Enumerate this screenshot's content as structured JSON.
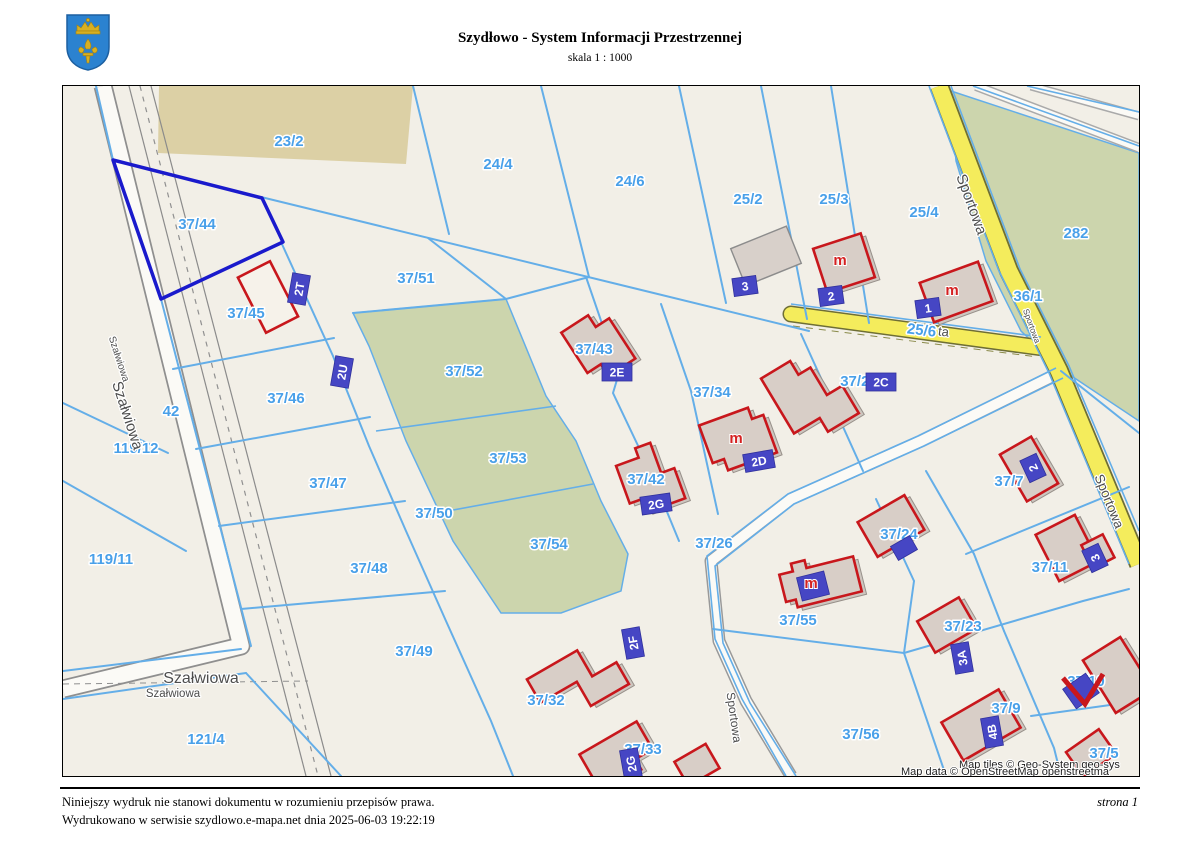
{
  "header": {
    "title": "Szydłowo - System Informacji Przestrzennej",
    "scale": "skala 1 : 1000"
  },
  "footer": {
    "disclaimer": "Niniejszy wydruk nie stanowi dokumentu w rozumieniu przepisów prawa.",
    "printed": "Wydrukowano w serwisie szydlowo.e-mapa.net dnia 2025-06-03 19:22:19",
    "page": "strona 1"
  },
  "map": {
    "attribution_tiles": "Map tiles © Geo-System geo-sys",
    "attribution_data": "Map data © OpenStreetMap openstreetma",
    "building_marker": "m",
    "streets": {
      "szalwiowa": "Szałwiowa",
      "sportowa": "Sportowa",
      "fragment": "ta"
    },
    "parcels": [
      {
        "label": "23/2"
      },
      {
        "label": "24/4"
      },
      {
        "label": "24/6"
      },
      {
        "label": "25/2"
      },
      {
        "label": "25/3"
      },
      {
        "label": "25/4"
      },
      {
        "label": "282"
      },
      {
        "label": "36/1"
      },
      {
        "label": "37/44"
      },
      {
        "label": "37/45"
      },
      {
        "label": "37/51"
      },
      {
        "label": "25/6"
      },
      {
        "label": "37/43"
      },
      {
        "label": "37/52"
      },
      {
        "label": "37/34"
      },
      {
        "label": "37/28"
      },
      {
        "label": "37/46"
      },
      {
        "label": "42"
      },
      {
        "label": "119/12"
      },
      {
        "label": "37/47"
      },
      {
        "label": "37/53"
      },
      {
        "label": "37/42"
      },
      {
        "label": "37/50"
      },
      {
        "label": "37/26"
      },
      {
        "label": "37/24"
      },
      {
        "label": "37/7"
      },
      {
        "label": "119/11"
      },
      {
        "label": "37/48"
      },
      {
        "label": "37/54"
      },
      {
        "label": "37/55"
      },
      {
        "label": "37/11"
      },
      {
        "label": "37/23"
      },
      {
        "label": "37/49"
      },
      {
        "label": "37/32"
      },
      {
        "label": "37/33"
      },
      {
        "label": "37/56"
      },
      {
        "label": "37/10"
      },
      {
        "label": "37/9"
      },
      {
        "label": "37/5"
      },
      {
        "label": "121/4"
      }
    ],
    "addresses": [
      {
        "label": "2T"
      },
      {
        "label": "2U"
      },
      {
        "label": "3"
      },
      {
        "label": "2"
      },
      {
        "label": "1"
      },
      {
        "label": "2E"
      },
      {
        "label": "2D"
      },
      {
        "label": "2C"
      },
      {
        "label": "2G"
      },
      {
        "label": "2F"
      },
      {
        "label": "2G"
      },
      {
        "label": "3A"
      },
      {
        "label": "4B"
      },
      {
        "label": "2"
      },
      {
        "label": "3"
      }
    ],
    "colors": {
      "selection": "#1a1acc",
      "parcel_line": "#64aee8",
      "building_outline": "#c8171c",
      "road_yellow": "#f4ec5c",
      "green_area": "#ccd5ad",
      "tan_area": "#dcd0a5",
      "parcel_label": "#49a0e9",
      "address_bg": "#4646c4"
    }
  }
}
